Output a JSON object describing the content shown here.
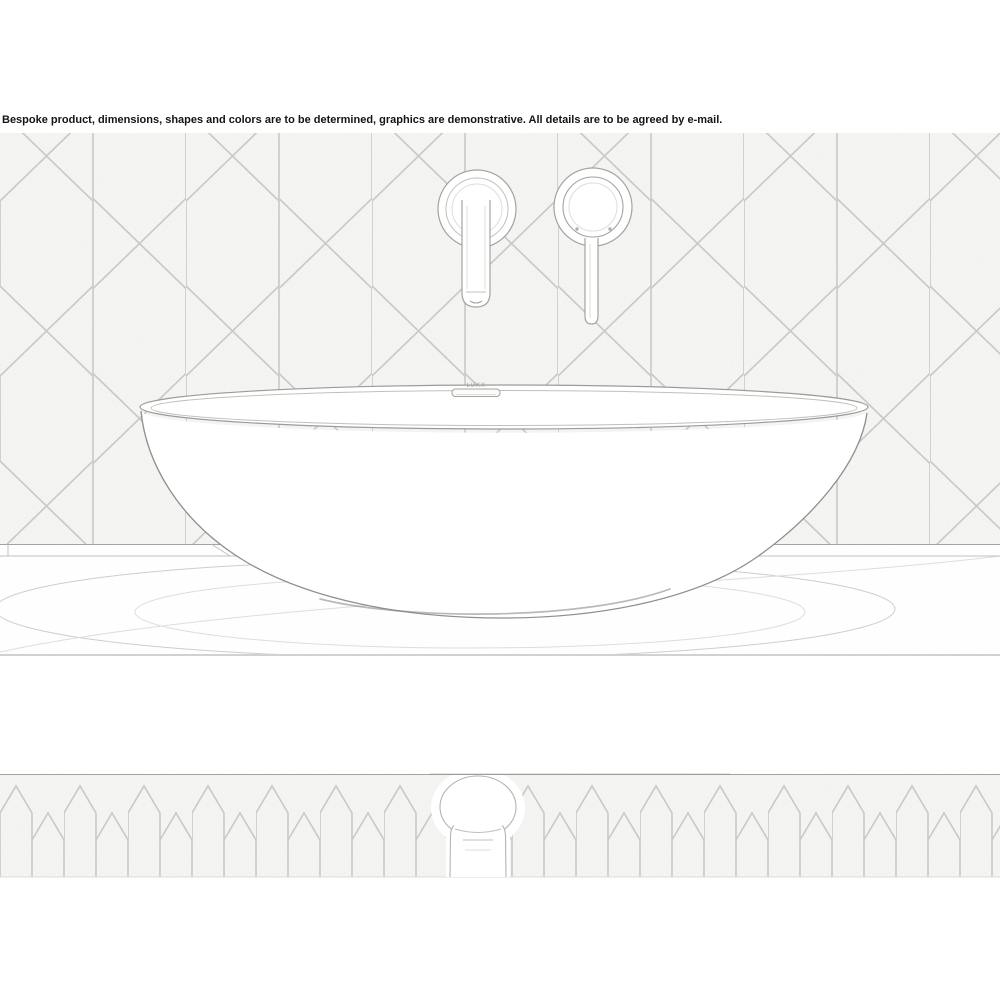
{
  "page": {
    "width": 1000,
    "height": 1000,
    "background": "#ffffff"
  },
  "disclaimer": {
    "text": "Bespoke product, dimensions, shapes and colors are to be determined, graphics are demonstrative. All details are to be agreed by e-mail."
  },
  "photo": {
    "brand_mark": "LUXX",
    "colors": {
      "ink_strong": "#8f8f8d",
      "ink": "#a3a3a1",
      "ink_soft": "#c0c0bd",
      "grout": "#c9c9c6",
      "tile": "#f5f5f3",
      "paper": "#ffffff",
      "text": "#141414"
    }
  }
}
